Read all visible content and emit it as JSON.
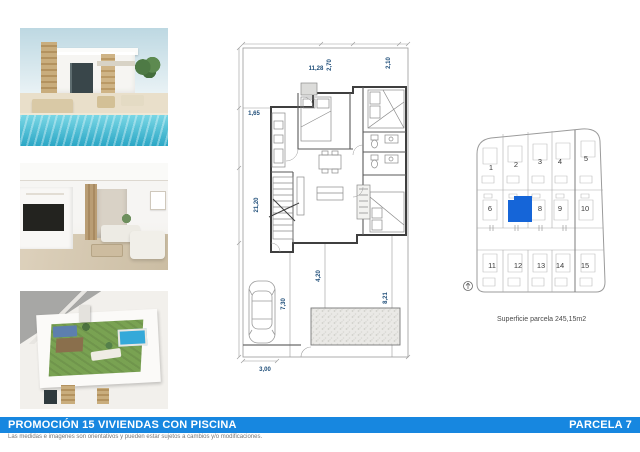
{
  "banner": {
    "title": "PROMOCIÓN 15 VIVIENDAS CON PISCINA",
    "parcel": "PARCELA 7",
    "bg_color": "#1787e0"
  },
  "disclaimer": "Las medidas e imagenes son orientativos y pueden estar sujetos a cambios y/o modificaciones.",
  "floor_plan": {
    "dim_color": "#1f4e79",
    "dims": {
      "top_width": "11,28",
      "top_inner": "2,70",
      "top_right": "2,10",
      "left_upper": "1,65",
      "left_height": "21,20",
      "drive_depth": "7,30",
      "yard_center": "4,20",
      "yard_right": "8,21",
      "pool_size": "6,00x 2,50",
      "bottom_width": "3,00"
    }
  },
  "site_plan": {
    "highlighted_plot": "7",
    "highlight_color": "#1565d8",
    "caption": "Superficie parcela 245,15m2",
    "plots": [
      "1",
      "2",
      "3",
      "4",
      "5",
      "6",
      "8",
      "9",
      "10",
      "11",
      "12",
      "13",
      "14",
      "15"
    ]
  }
}
